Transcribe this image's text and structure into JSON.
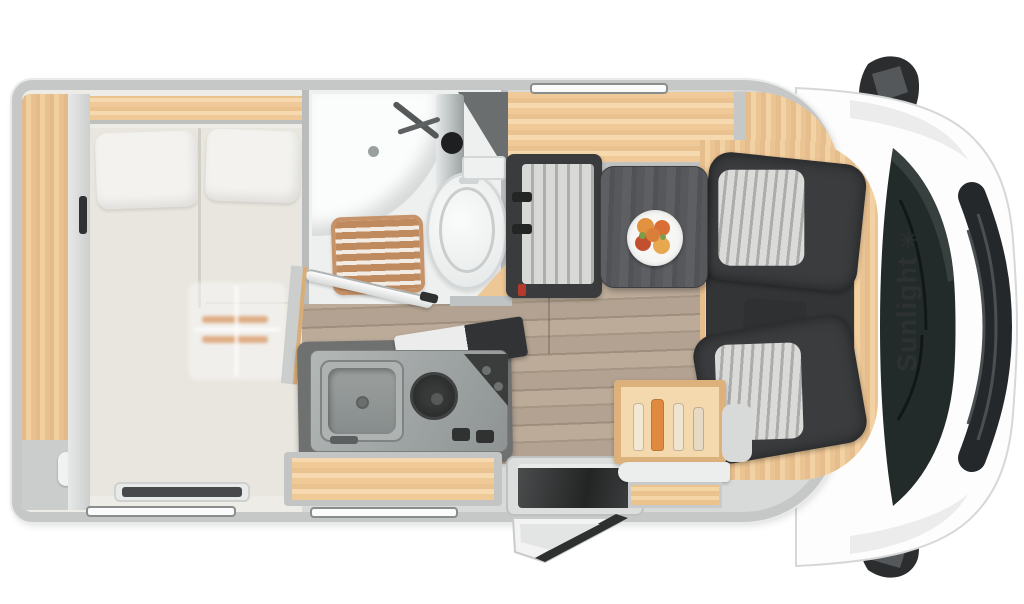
{
  "brand": {
    "label": "Sunlight",
    "logo_glyph": "✳",
    "logo_icon": "starburst-icon",
    "text_color": "#2e3134"
  },
  "palette": {
    "wall": "#c6c8c8",
    "wood": "#edc795",
    "wood-dark": "#d9ad76",
    "wood-light": "#f6d9ae",
    "floor": "#b2a291",
    "mattress": "#e9e6df",
    "bath": "#eef0f0",
    "seat-dark": "#353738",
    "stripe-l": "#d8d8d6",
    "stripe-d": "#a9a9a7",
    "table": "#55575b",
    "counter": "#6f7171",
    "steel": "#a7acab",
    "windshield": "#232b2a",
    "brand": "#2e3134",
    "grate": "#bc8458",
    "accent": "#df8a3e"
  }
}
